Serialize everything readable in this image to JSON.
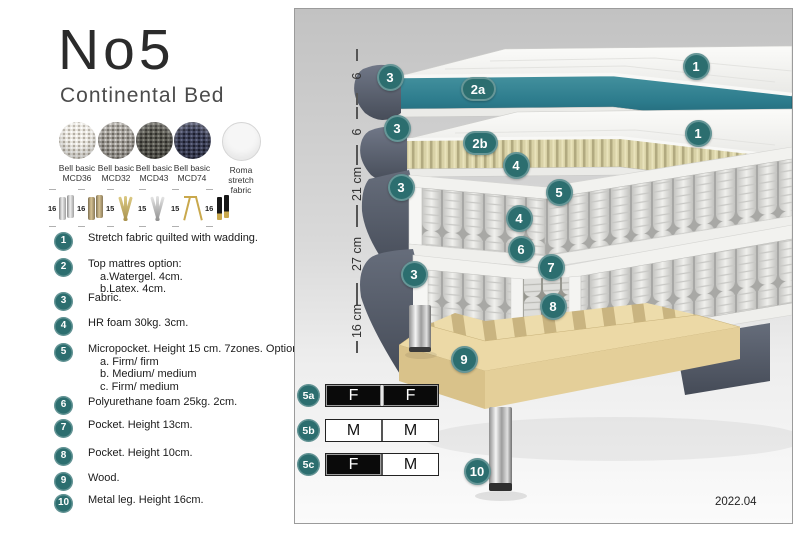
{
  "page": {
    "title": "No5",
    "subtitle": "Continental Bed",
    "version": "2022.04"
  },
  "fabric_swatches": [
    {
      "line1": "Bell basic",
      "line2": "MCD36"
    },
    {
      "line1": "Bell basic",
      "line2": "MCD32"
    },
    {
      "line1": "Bell basic",
      "line2": "MCD43"
    },
    {
      "line1": "Bell basic",
      "line2": "MCD74"
    },
    {
      "line1": "Roma",
      "line2": "stretch fabric"
    }
  ],
  "leg_options": [
    {
      "height": "16",
      "style": "cyl-silver"
    },
    {
      "height": "16",
      "style": "cyl-bronze"
    },
    {
      "height": "15",
      "style": "twist-gold"
    },
    {
      "height": "15",
      "style": "twist-silver"
    },
    {
      "height": "15",
      "style": "hairpin-gold"
    },
    {
      "height": "16",
      "style": "block-black"
    }
  ],
  "legend": [
    {
      "num": "1",
      "text": "Stretch fabric quilted with wadding.",
      "sub": []
    },
    {
      "num": "2",
      "text": "Top mattres option:",
      "sub": [
        "a.Watergel. 4cm.",
        "b.Latex. 4cm."
      ]
    },
    {
      "num": "3",
      "text": "Fabric.",
      "sub": []
    },
    {
      "num": "4",
      "text": "HR foam 30kg. 3cm.",
      "sub": []
    },
    {
      "num": "5",
      "text": "Micropocket. Height 15 cm. 7zones. Option:",
      "sub": [
        "a. Firm/ firm",
        "b. Medium/ medium",
        "c. Firm/ medium"
      ]
    },
    {
      "num": "6",
      "text": "Polyurethane foam 25kg. 2cm.",
      "sub": []
    },
    {
      "num": "7",
      "text": "Pocket. Height 13cm.",
      "sub": []
    },
    {
      "num": "8",
      "text": "Pocket. Height 10cm.",
      "sub": []
    },
    {
      "num": "9",
      "text": "Wood.",
      "sub": []
    },
    {
      "num": "10",
      "text": "Metal leg. Height 16cm.",
      "sub": []
    }
  ],
  "diagram": {
    "ruler_labels": [
      "6",
      "6",
      "21 cm",
      "27 cm",
      "16 cm"
    ],
    "callout_labels": [
      "1",
      "2a",
      "1",
      "2b",
      "3",
      "3",
      "3",
      "3",
      "4",
      "4",
      "5",
      "6",
      "7",
      "8",
      "9",
      "10"
    ],
    "firmness_rows": [
      {
        "label": "5a",
        "cells": [
          {
            "letter": "F",
            "variant": "black"
          },
          {
            "letter": "F",
            "variant": "black"
          }
        ]
      },
      {
        "label": "5b",
        "cells": [
          {
            "letter": "M",
            "variant": "white"
          },
          {
            "letter": "M",
            "variant": "white"
          }
        ]
      },
      {
        "label": "5c",
        "cells": [
          {
            "letter": "F",
            "variant": "black"
          },
          {
            "letter": "M",
            "variant": "white"
          }
        ]
      }
    ],
    "colors": {
      "callout_teal": "#2c6e6f",
      "watergel_teal": "#2e7f8f",
      "latex_tan": "#d8d1a6",
      "fabric_gray": "#5a6170",
      "wood_tan": "#e9d7a4"
    }
  }
}
